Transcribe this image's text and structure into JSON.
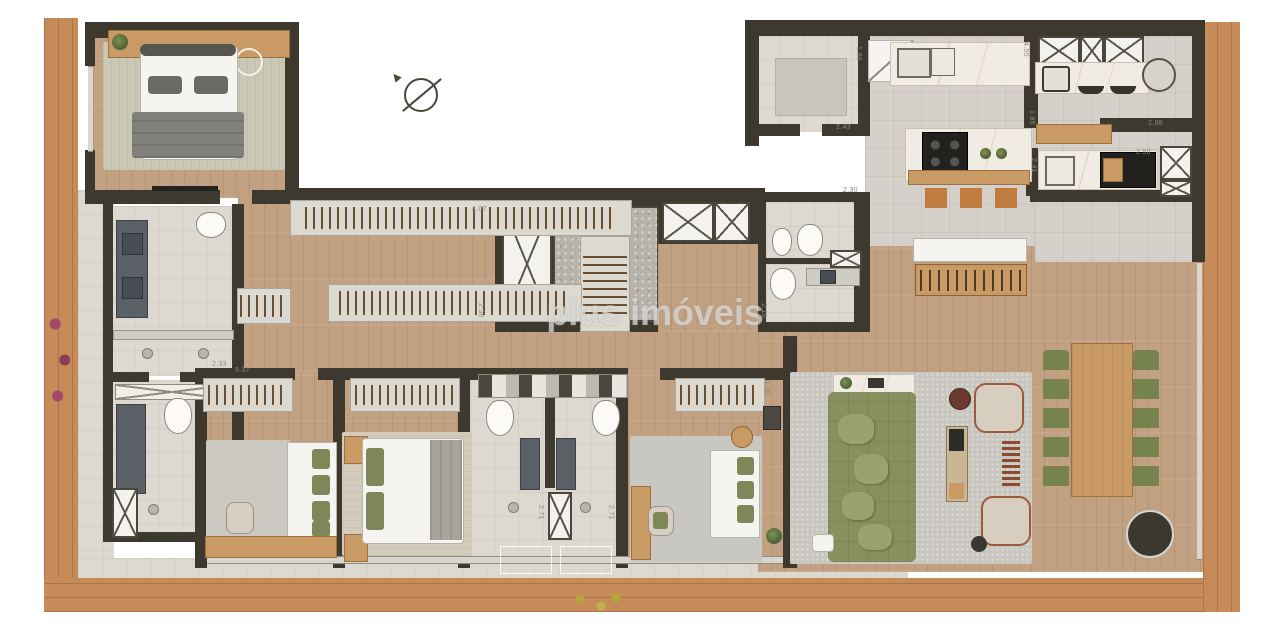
{
  "watermark": {
    "text": "plus imóveis"
  },
  "compass": {
    "icon": "north-arrow"
  },
  "dimensions": [
    {
      "text": "4.07",
      "x": 472,
      "y": 206,
      "vertical": false
    },
    {
      "text": "2.36",
      "x": 477,
      "y": 303,
      "vertical": true
    },
    {
      "text": "2.33",
      "x": 212,
      "y": 361,
      "vertical": false
    },
    {
      "text": "9.37",
      "x": 235,
      "y": 367,
      "vertical": false
    },
    {
      "text": "2.30",
      "x": 843,
      "y": 187,
      "vertical": false
    },
    {
      "text": "2.10",
      "x": 760,
      "y": 303,
      "vertical": true
    },
    {
      "text": "1.88",
      "x": 855,
      "y": 46,
      "vertical": true
    },
    {
      "text": "2.43",
      "x": 836,
      "y": 124,
      "vertical": false
    },
    {
      "text": "4.50",
      "x": 1022,
      "y": 42,
      "vertical": true
    },
    {
      "text": "1.85",
      "x": 1028,
      "y": 110,
      "vertical": true
    },
    {
      "text": "2.88",
      "x": 1148,
      "y": 120,
      "vertical": false
    },
    {
      "text": "2.41",
      "x": 1030,
      "y": 158,
      "vertical": true
    },
    {
      "text": "2.50",
      "x": 1136,
      "y": 149,
      "vertical": false
    },
    {
      "text": "2.71",
      "x": 537,
      "y": 505,
      "vertical": true
    },
    {
      "text": "2.71",
      "x": 607,
      "y": 505,
      "vertical": true
    },
    {
      "text": "4.30",
      "x": 763,
      "y": 380,
      "vertical": true
    }
  ],
  "colors": {
    "deck_wood": "#c78a59",
    "wall": "#3d392f",
    "interior_wood": "#c2a183",
    "tile": "#ddd9d1",
    "kitchen_tile": "#d5d1ca",
    "sofa_green": "#87905e",
    "chair_green": "#76834f",
    "furniture_wood": "#c99a63",
    "marble": "#f1ece3",
    "vanity_gray": "#5b6067",
    "rug_gray": "#c8c6bf",
    "rug_sage": "#c9c8b4"
  }
}
